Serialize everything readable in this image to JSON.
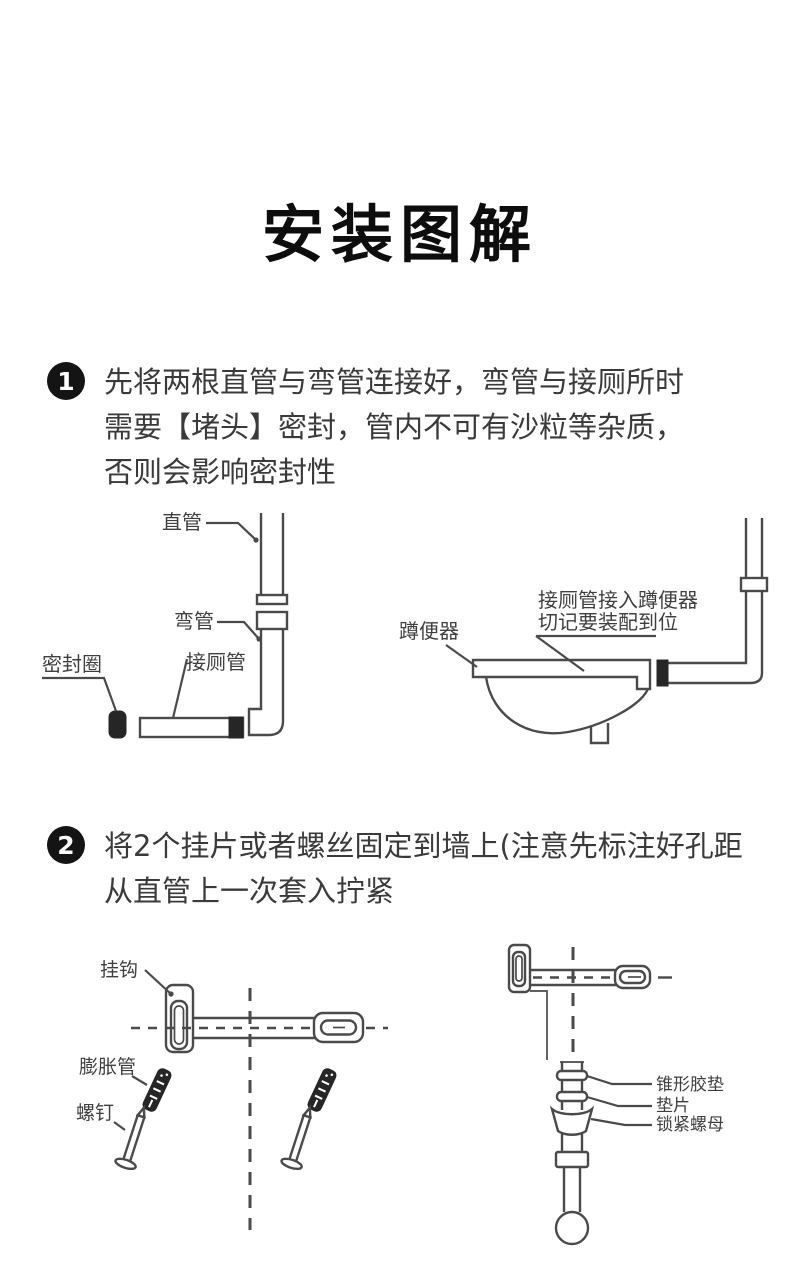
{
  "title": "安装图解",
  "steps": [
    {
      "number": "1",
      "lines": [
        "先将两根直管与弯管连接好，弯管与接厕所时",
        "需要【堵头】密封，管内不可有沙粒等杂质，",
        "否则会影响密封性"
      ]
    },
    {
      "number": "2",
      "lines": [
        "将2个挂片或者螺丝固定到墙上(注意先标注好孔距",
        "从直管上一次套入拧紧"
      ]
    }
  ],
  "diagram1": {
    "labels": {
      "straight_pipe": "直管",
      "elbow_pipe": "弯管",
      "seal_ring": "密封圈",
      "toilet_pipe": "接厕管",
      "squat_pan": "蹲便器",
      "note_line1": "接厕管接入蹲便器",
      "note_line2": "切记要装配到位"
    }
  },
  "diagram2": {
    "labels": {
      "hook": "挂钩",
      "expansion_tube": "膨胀管",
      "screw": "螺钉",
      "cone_rubber_pad": "锥形胶垫",
      "washer": "垫片",
      "lock_nut": "锁紧螺母"
    }
  },
  "colors": {
    "background": "#ffffff",
    "line": "#4a4a4a",
    "text": "#3a3a3a",
    "badge": "#141414",
    "dark_fill": "#262626"
  }
}
